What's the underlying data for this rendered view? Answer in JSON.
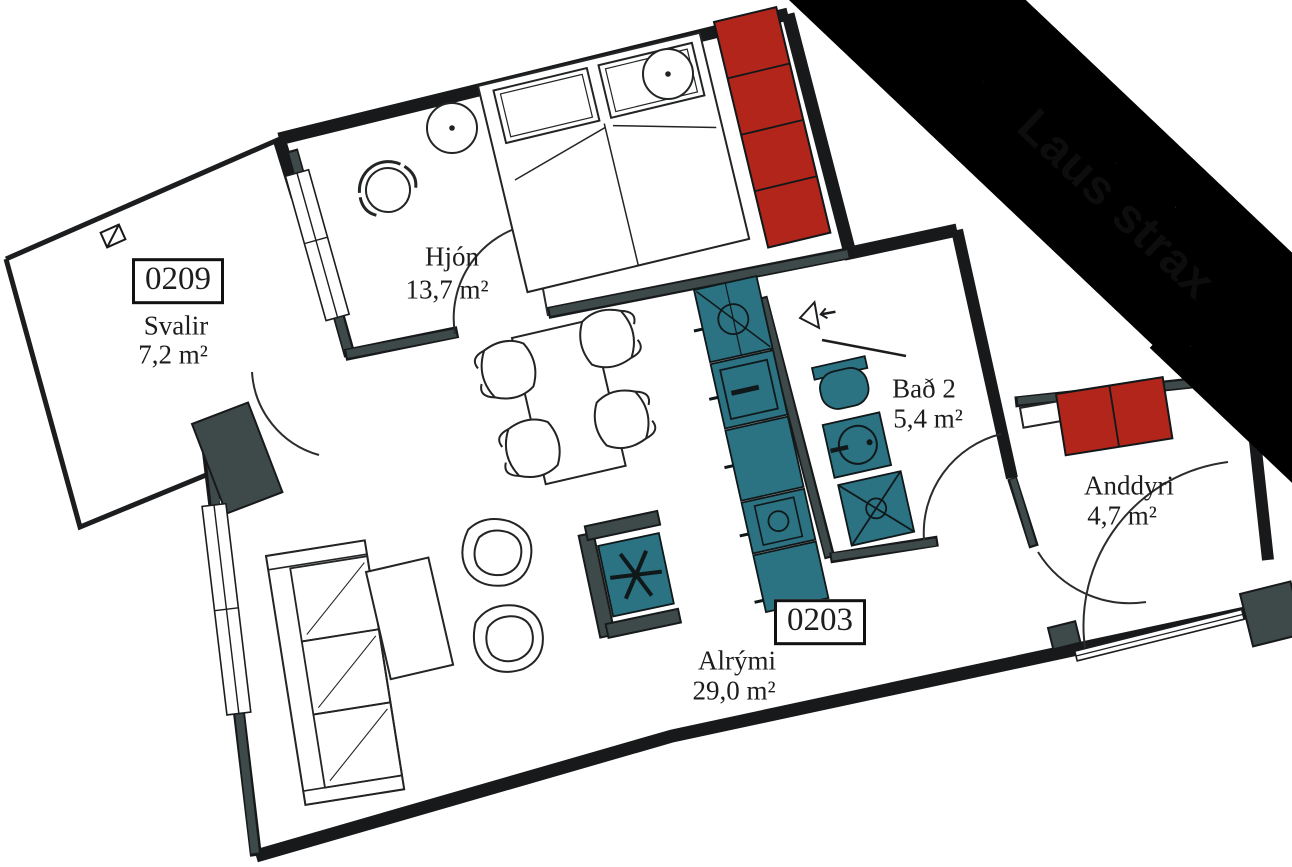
{
  "banner": {
    "text": "Laus strax",
    "background": "#c2a10e",
    "text_color": "#0d0d0d"
  },
  "rooms": {
    "svalir": {
      "unit_number": "0209",
      "name": "Svalir",
      "area": "7,2 m²"
    },
    "hjon": {
      "name": "Hjón",
      "area": "13,7 m²"
    },
    "bad2": {
      "name": "Bað 2",
      "area": "5,4 m²"
    },
    "anddyri": {
      "name": "Anddyri",
      "area": "4,7 m²"
    },
    "alrymi": {
      "unit_number": "0203",
      "name": "Alrými",
      "area": "29,0 m²"
    }
  },
  "colors": {
    "wall": "#17191b",
    "partition": "#3e4a49",
    "teal": "#2b7282",
    "red": "#b1251a",
    "gold": "#c2a10e",
    "ink": "#1d1d1d",
    "bg": "#ffffff"
  }
}
